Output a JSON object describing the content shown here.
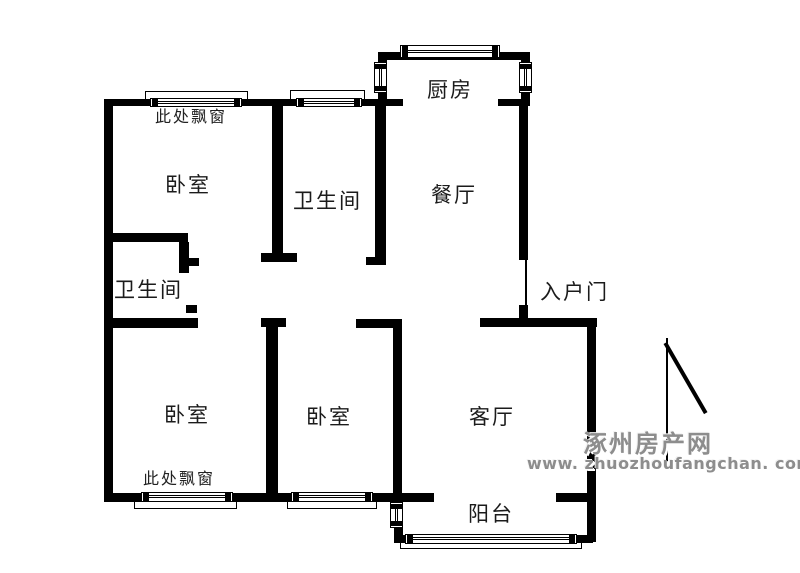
{
  "plan": {
    "labels": {
      "kitchen": "厨房",
      "dining": "餐厅",
      "living_room": "客厅",
      "balcony": "阳台",
      "entry_door": "入户门",
      "bedroom_top_left": "卧室",
      "bedroom_bottom_left": "卧室",
      "bedroom_bottom_middle": "卧室",
      "bathroom_top": "卫生间",
      "bathroom_left": "卫生间",
      "bay_window_note_top": "此处飘窗",
      "bay_window_note_bottom": "此处飘窗"
    },
    "colors": {
      "wall": "#000000",
      "background": "#ffffff",
      "watermark_gray": "#8d8d8d"
    }
  },
  "watermark": {
    "site_name": "涿州房产网",
    "site_url": "www. zhuozhoufangchan. com"
  }
}
